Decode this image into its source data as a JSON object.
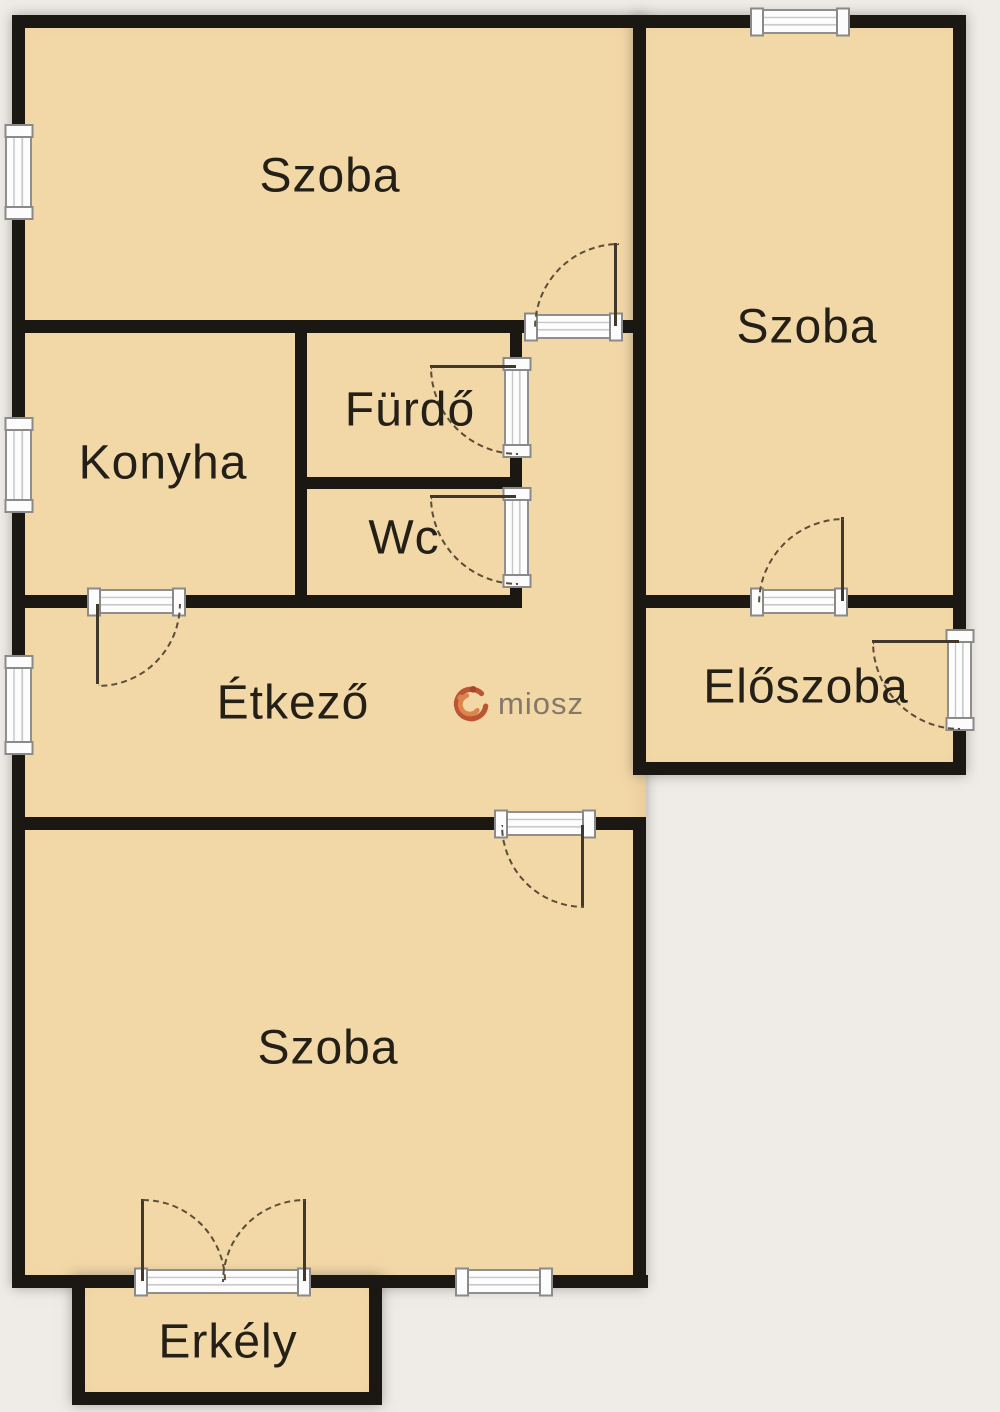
{
  "plan": {
    "title": "apartment-floor-plan",
    "rooms": [
      {
        "id": "szoba-top-left",
        "label": "Szoba"
      },
      {
        "id": "szoba-top-right",
        "label": "Szoba"
      },
      {
        "id": "furdo",
        "label": "Fürdő"
      },
      {
        "id": "konyha",
        "label": "Konyha"
      },
      {
        "id": "wc",
        "label": "Wc"
      },
      {
        "id": "etkezo",
        "label": "Étkező"
      },
      {
        "id": "eloszoba",
        "label": "Előszoba"
      },
      {
        "id": "szoba-bottom",
        "label": "Szoba"
      },
      {
        "id": "erkely",
        "label": "Erkély"
      }
    ],
    "watermark": {
      "text": "miosz",
      "icon": "miosz-logo-icon"
    },
    "colors": {
      "room_fill": "#f3d8a7",
      "wall": "#1b1713",
      "background": "#efece7",
      "label_text": "#242018",
      "slab_fill": "#fdfdfd",
      "slab_border": "#8f8f8f",
      "swing_line": "#5b4d38",
      "watermark_text": "#7b7064",
      "logo_primary": "#b84a2a",
      "logo_secondary": "#d97e45"
    }
  }
}
